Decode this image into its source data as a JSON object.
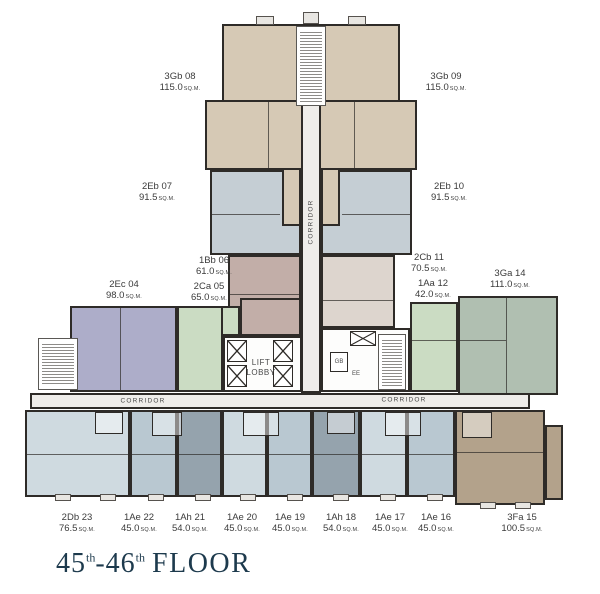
{
  "title": {
    "floor_a": "45",
    "sup_a": "th",
    "dash": "-",
    "floor_b": "46",
    "sup_b": "th",
    "word": "FLOOR"
  },
  "labels": {
    "corridor_left": "CORRIDOR",
    "corridor_right": "CORRIDOR",
    "corridor_vertical": "CORRIDOR",
    "lift_line1": "LIFT",
    "lift_line2": "LOBBY",
    "gb": "GB",
    "ee": "EE",
    "area_unit": "SQ.M."
  },
  "units": [
    {
      "id": "3Gb-08",
      "code": "3Gb 08",
      "area": "115.0"
    },
    {
      "id": "3Gb-09",
      "code": "3Gb 09",
      "area": "115.0"
    },
    {
      "id": "2Eb-07",
      "code": "2Eb 07",
      "area": "91.5"
    },
    {
      "id": "2Eb-10",
      "code": "2Eb 10",
      "area": "91.5"
    },
    {
      "id": "1Bb-06",
      "code": "1Bb 06",
      "area": "61.0"
    },
    {
      "id": "2Cb-11",
      "code": "2Cb 11",
      "area": "70.5"
    },
    {
      "id": "2Ec-04",
      "code": "2Ec 04",
      "area": "98.0"
    },
    {
      "id": "2Ca-05",
      "code": "2Ca 05",
      "area": "65.0"
    },
    {
      "id": "1Aa-12",
      "code": "1Aa 12",
      "area": "42.0"
    },
    {
      "id": "3Ga-14",
      "code": "3Ga 14",
      "area": "111.0"
    },
    {
      "id": "2Db-23",
      "code": "2Db 23",
      "area": "76.5"
    },
    {
      "id": "1Ae-22",
      "code": "1Ae 22",
      "area": "45.0"
    },
    {
      "id": "1Ah-21",
      "code": "1Ah 21",
      "area": "54.0"
    },
    {
      "id": "1Ae-20",
      "code": "1Ae 20",
      "area": "45.0"
    },
    {
      "id": "1Ae-19",
      "code": "1Ae 19",
      "area": "45.0"
    },
    {
      "id": "1Ah-18",
      "code": "1Ah 18",
      "area": "54.0"
    },
    {
      "id": "1Ae-17",
      "code": "1Ae 17",
      "area": "45.0"
    },
    {
      "id": "1Ae-16",
      "code": "1Ae 16",
      "area": "45.0"
    },
    {
      "id": "3Fa-15",
      "code": "3Fa 15",
      "area": "100.5"
    }
  ],
  "colors": {
    "beige": "#d6c9b5",
    "grayblue": "#c5ced4",
    "mauve": "#c2aea8",
    "greige": "#ddd5ce",
    "lavender": "#adadc9",
    "green": "#cbdcc3",
    "sage": "#b0bfb1",
    "blue_light": "#cfdae0",
    "blue_med": "#b9c8d1",
    "blue_dark": "#95a3ad",
    "tan": "#b3a28b",
    "corridor": "#efedea",
    "wall": "#2e2b28",
    "title": "#1d3a4d",
    "label_text": "#3b3b3b"
  }
}
